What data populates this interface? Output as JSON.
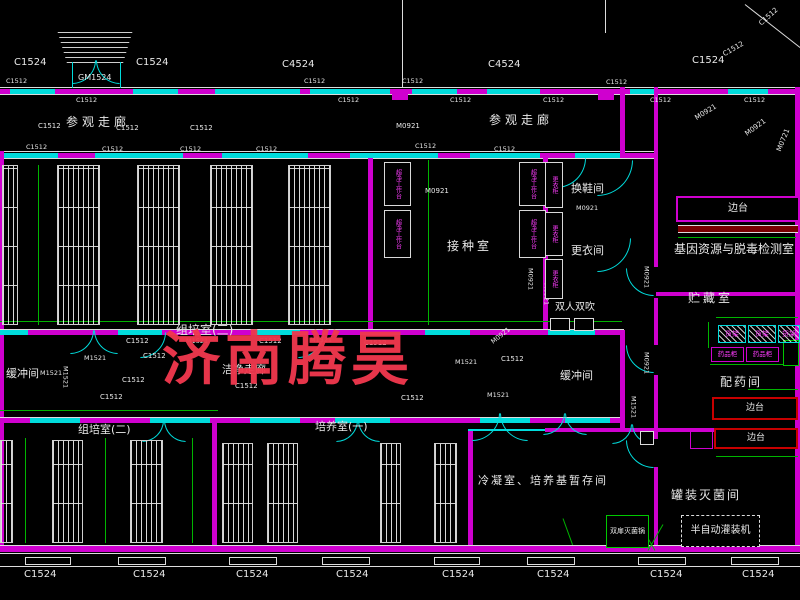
{
  "watermark": {
    "text": "济南腾昊",
    "color": "#f0384e"
  },
  "colors": {
    "wall_magenta": "#cf00cf",
    "window_cyan": "#00dcdc",
    "dim_green": "#00b400",
    "line_white": "#dcdcdc",
    "bench_red": "#c80000",
    "highlight_yellow": "#d8d800"
  },
  "labels": [
    {
      "n": "dim-c1524-1",
      "t": "C1524",
      "x": 14,
      "y": 58,
      "s": 10
    },
    {
      "n": "dim-c1524-2",
      "t": "C1524",
      "x": 136,
      "y": 58,
      "s": 10
    },
    {
      "n": "door-gm1524",
      "t": "GM1524",
      "x": 78,
      "y": 74,
      "s": 8
    },
    {
      "n": "dim-c4524-1",
      "t": "C4524",
      "x": 282,
      "y": 60,
      "s": 10
    },
    {
      "n": "dim-c4524-2",
      "t": "C4524",
      "x": 488,
      "y": 60,
      "s": 10
    },
    {
      "n": "dim-c1524-3",
      "t": "C1524",
      "x": 692,
      "y": 56,
      "s": 10
    },
    {
      "n": "dim-c1512-d1",
      "t": "C1512",
      "x": 722,
      "y": 52,
      "s": 7,
      "rot": -30
    },
    {
      "n": "dim-c1512-d2",
      "t": "C1512",
      "x": 758,
      "y": 22,
      "s": 7,
      "rot": -42
    },
    {
      "n": "dim-c1512",
      "t": "C1512",
      "x": 6,
      "y": 78,
      "s": 6.5
    },
    {
      "n": "dim-c1512",
      "t": "C1512",
      "x": 304,
      "y": 78,
      "s": 6.5
    },
    {
      "n": "dim-c1512",
      "t": "C1512",
      "x": 402,
      "y": 78,
      "s": 6.5
    },
    {
      "n": "dim-c1512",
      "t": "C1512",
      "x": 606,
      "y": 79,
      "s": 6.5
    },
    {
      "n": "dim-c1512",
      "t": "C1512",
      "x": 76,
      "y": 97,
      "s": 6.5
    },
    {
      "n": "dim-c1512",
      "t": "C1512",
      "x": 338,
      "y": 97,
      "s": 6.5
    },
    {
      "n": "dim-c1512",
      "t": "C1512",
      "x": 450,
      "y": 97,
      "s": 6.5
    },
    {
      "n": "dim-c1512",
      "t": "C1512",
      "x": 543,
      "y": 97,
      "s": 6.5
    },
    {
      "n": "dim-c1512",
      "t": "C1512",
      "x": 650,
      "y": 97,
      "s": 6.5
    },
    {
      "n": "dim-c1512",
      "t": "C1512",
      "x": 744,
      "y": 97,
      "s": 6.5
    },
    {
      "n": "dim-c1512",
      "t": "C1512",
      "x": 38,
      "y": 123,
      "s": 7
    },
    {
      "n": "room-visitor-corridor-1",
      "t": "参观走廊",
      "x": 66,
      "y": 116,
      "s": 12,
      "ls": 4
    },
    {
      "n": "dim-c1512",
      "t": "C1512",
      "x": 116,
      "y": 125,
      "s": 7
    },
    {
      "n": "dim-c1512",
      "t": "C1512",
      "x": 190,
      "y": 125,
      "s": 7
    },
    {
      "n": "dim-m0921",
      "t": "M0921",
      "x": 396,
      "y": 123,
      "s": 7
    },
    {
      "n": "room-visitor-corridor-2",
      "t": "参观走廊",
      "x": 489,
      "y": 114,
      "s": 12,
      "ls": 4
    },
    {
      "n": "dim-c1512",
      "t": "C1512",
      "x": 26,
      "y": 144,
      "s": 6.5
    },
    {
      "n": "dim-c1512",
      "t": "C1512",
      "x": 102,
      "y": 146,
      "s": 6.5
    },
    {
      "n": "dim-c1512",
      "t": "C1512",
      "x": 180,
      "y": 146,
      "s": 6.5
    },
    {
      "n": "dim-c1512",
      "t": "C1512",
      "x": 256,
      "y": 146,
      "s": 6.5
    },
    {
      "n": "dim-c1512",
      "t": "C1512",
      "x": 415,
      "y": 143,
      "s": 6.5
    },
    {
      "n": "dim-c1512",
      "t": "C1512",
      "x": 494,
      "y": 146,
      "s": 6.5
    },
    {
      "n": "dim-m0921-d",
      "t": "M0921",
      "x": 694,
      "y": 116,
      "s": 7,
      "rot": -32
    },
    {
      "n": "dim-m0921-d",
      "t": "M0921",
      "x": 744,
      "y": 132,
      "s": 7,
      "rot": -36
    },
    {
      "n": "dim-m0721-d",
      "t": "M0721",
      "x": 776,
      "y": 150,
      "s": 7,
      "rot": -68
    },
    {
      "n": "room-inoculation",
      "t": "接种室",
      "x": 447,
      "y": 240,
      "s": 12,
      "ls": 3
    },
    {
      "n": "dim-m0921",
      "t": "M0921",
      "x": 425,
      "y": 188,
      "s": 7
    },
    {
      "n": "dim-m0921",
      "t": "M0921",
      "x": 527,
      "y": 268,
      "s": 6.5,
      "v": true
    },
    {
      "n": "room-shoe-change",
      "t": "换鞋间",
      "x": 571,
      "y": 183,
      "s": 11
    },
    {
      "n": "dim-m0921",
      "t": "M0921",
      "x": 576,
      "y": 205,
      "s": 6.5
    },
    {
      "n": "room-dressing",
      "t": "更衣间",
      "x": 571,
      "y": 245,
      "s": 11
    },
    {
      "n": "room-air-shower",
      "t": "双人双吹",
      "x": 555,
      "y": 303,
      "s": 10
    },
    {
      "n": "dim-m0921",
      "t": "M0921",
      "x": 543,
      "y": 283,
      "s": 6.5,
      "v": true
    },
    {
      "n": "room-buffer-right",
      "t": "缓冲间",
      "x": 560,
      "y": 370,
      "s": 11
    },
    {
      "n": "dim-m1521",
      "t": "M1521",
      "x": 630,
      "y": 396,
      "s": 6.5,
      "v": true
    },
    {
      "n": "room-gene-detection",
      "t": "基因资源与脱毒检测室",
      "x": 674,
      "y": 243,
      "s": 12
    },
    {
      "n": "room-storage",
      "t": "贮藏室",
      "x": 688,
      "y": 292,
      "s": 12,
      "ls": 3
    },
    {
      "n": "room-dispensing",
      "t": "配药间",
      "x": 720,
      "y": 376,
      "s": 12,
      "ls": 2
    },
    {
      "n": "room-canning-sterilization",
      "t": "罐装灭菌间",
      "x": 671,
      "y": 489,
      "s": 12,
      "ls": 2
    },
    {
      "n": "dim-m0921",
      "t": "M0921",
      "x": 643,
      "y": 266,
      "s": 6.5,
      "v": true
    },
    {
      "n": "dim-m0921",
      "t": "M0921",
      "x": 643,
      "y": 352,
      "s": 6.5,
      "v": true
    },
    {
      "n": "room-tissue-culture-3",
      "t": "组培室(三)",
      "x": 176,
      "y": 324,
      "s": 12
    },
    {
      "n": "room-clean-corridor",
      "t": "洁净走廊",
      "x": 222,
      "y": 364,
      "s": 11
    },
    {
      "n": "room-buffer-left",
      "t": "缓冲间",
      "x": 6,
      "y": 368,
      "s": 11
    },
    {
      "n": "dim-m1521",
      "t": "M1521",
      "x": 40,
      "y": 370,
      "s": 6.5
    },
    {
      "n": "dim-m1521",
      "t": "M1521",
      "x": 62,
      "y": 366,
      "s": 6.5,
      "v": true
    },
    {
      "n": "dim-m1521",
      "t": "M1521",
      "x": 84,
      "y": 355,
      "s": 6.5
    },
    {
      "n": "dim-c1512",
      "t": "C1512",
      "x": 143,
      "y": 353,
      "s": 7
    },
    {
      "n": "dim-c1512",
      "t": "C1512",
      "x": 122,
      "y": 377,
      "s": 7
    },
    {
      "n": "dim-c1512",
      "t": "C1512",
      "x": 100,
      "y": 394,
      "s": 7
    },
    {
      "n": "dim-c1512",
      "t": "C1512",
      "x": 126,
      "y": 338,
      "s": 7
    },
    {
      "n": "dim-m1521",
      "t": "M1521",
      "x": 186,
      "y": 338,
      "s": 6.5
    },
    {
      "n": "dim-c1512",
      "t": "C1512",
      "x": 259,
      "y": 338,
      "s": 7
    },
    {
      "n": "dim-m1521",
      "t": "M1521",
      "x": 310,
      "y": 337,
      "s": 6.5
    },
    {
      "n": "dim-c1512",
      "t": "C1512",
      "x": 364,
      "y": 340,
      "s": 7
    },
    {
      "n": "dim-c1512",
      "t": "C1512",
      "x": 235,
      "y": 383,
      "s": 7
    },
    {
      "n": "dim-m1521",
      "t": "M1521",
      "x": 455,
      "y": 359,
      "s": 6.5
    },
    {
      "n": "dim-c1512",
      "t": "C1512",
      "x": 501,
      "y": 356,
      "s": 7
    },
    {
      "n": "dim-m0921-d",
      "t": "M0921",
      "x": 490,
      "y": 340,
      "s": 6.5,
      "rot": -38
    },
    {
      "n": "dim-m1521",
      "t": "M1521",
      "x": 487,
      "y": 392,
      "s": 6.5
    },
    {
      "n": "dim-c1512",
      "t": "C1512",
      "x": 401,
      "y": 395,
      "s": 7
    },
    {
      "n": "room-culture-1",
      "t": "培养室(一)",
      "x": 315,
      "y": 421,
      "s": 11
    },
    {
      "n": "room-tissue-culture-2",
      "t": "组培室(二)",
      "x": 78,
      "y": 424,
      "s": 11
    },
    {
      "n": "room-condensing",
      "t": "冷凝室、培养基暂存间",
      "x": 478,
      "y": 475,
      "s": 11,
      "ls": 2
    },
    {
      "n": "dim-c1524-b",
      "t": "C1524",
      "x": 24,
      "y": 570,
      "s": 10
    },
    {
      "n": "dim-c1524-b",
      "t": "C1524",
      "x": 133,
      "y": 570,
      "s": 10
    },
    {
      "n": "dim-c1524-b",
      "t": "C1524",
      "x": 236,
      "y": 570,
      "s": 10
    },
    {
      "n": "dim-c1524-b",
      "t": "C1524",
      "x": 336,
      "y": 570,
      "s": 10
    },
    {
      "n": "dim-c1524-b",
      "t": "C1524",
      "x": 442,
      "y": 570,
      "s": 10
    },
    {
      "n": "dim-c1524-b",
      "t": "C1524",
      "x": 537,
      "y": 570,
      "s": 10
    },
    {
      "n": "dim-c1524-b",
      "t": "C1524",
      "x": 650,
      "y": 570,
      "s": 10
    },
    {
      "n": "dim-c1524-b",
      "t": "C1524",
      "x": 742,
      "y": 570,
      "s": 10
    }
  ],
  "boxes": [
    {
      "n": "bench-side-table-detect",
      "t": "边台",
      "x": 676,
      "y": 196,
      "w": 124,
      "h": 26,
      "bc": "#cf00cf",
      "bw": 2,
      "tc": "#e8e8e8",
      "s": 10
    },
    {
      "n": "shelf-rack-1",
      "t": "货架",
      "x": 718,
      "y": 325,
      "w": 28,
      "h": 18,
      "bc": "#00dcdc",
      "bw": 1,
      "tc": "#ff3cff",
      "s": 7,
      "hatch": true
    },
    {
      "n": "shelf-rack-2",
      "t": "货架",
      "x": 748,
      "y": 325,
      "w": 28,
      "h": 18,
      "bc": "#00dcdc",
      "bw": 1,
      "tc": "#ff3cff",
      "s": 7,
      "hatch": true
    },
    {
      "n": "shelf-rack-3",
      "t": "货架",
      "x": 778,
      "y": 325,
      "w": 22,
      "h": 18,
      "bc": "#00dcdc",
      "bw": 1,
      "tc": "#ff3cff",
      "s": 7,
      "hatch": true
    },
    {
      "n": "medicine-cabinet-1",
      "t": "药品柜",
      "x": 711,
      "y": 347,
      "w": 33,
      "h": 15,
      "bc": "#cf00cf",
      "bw": 1,
      "tc": "#ff3cff",
      "s": 6.5
    },
    {
      "n": "medicine-cabinet-2",
      "t": "药品柜",
      "x": 746,
      "y": 347,
      "w": 33,
      "h": 15,
      "bc": "#cf00cf",
      "bw": 1,
      "tc": "#ff3cff",
      "s": 6.5
    },
    {
      "n": "bench-side-table-dispense",
      "t": "边台",
      "x": 712,
      "y": 397,
      "w": 86,
      "h": 23,
      "bc": "#c80000",
      "bw": 2,
      "tc": "#e8e8e8",
      "s": 9
    },
    {
      "n": "bench-side-table-canning",
      "t": "边台",
      "x": 714,
      "y": 428,
      "w": 84,
      "h": 21,
      "bc": "#c80000",
      "bw": 2,
      "tc": "#e8e8e8",
      "s": 9
    },
    {
      "n": "double-door-sterilizer",
      "t": "双扉灭菌锅",
      "x": 606,
      "y": 515,
      "w": 43,
      "h": 33,
      "bc": "#00c800",
      "bw": 1,
      "tc": "#e8e8e8",
      "s": 7
    },
    {
      "n": "semi-auto-filling-machine",
      "t": "半自动灌装机",
      "x": 681,
      "y": 515,
      "w": 79,
      "h": 32,
      "bc": "#dcdcdc",
      "bw": 1,
      "tc": "#e8e8e8",
      "s": 10,
      "dash": true
    },
    {
      "n": "clean-bench",
      "t": "超净工作台",
      "x": 384,
      "y": 162,
      "w": 27,
      "h": 44,
      "bc": "#d8d8d8",
      "bw": 1,
      "tc": "#ff3cff",
      "s": 6,
      "v": true
    },
    {
      "n": "clean-bench",
      "t": "超净工作台",
      "x": 384,
      "y": 210,
      "w": 27,
      "h": 48,
      "bc": "#d8d8d8",
      "bw": 1,
      "tc": "#ff3cff",
      "s": 6,
      "v": true
    },
    {
      "n": "clean-bench",
      "t": "超净工作台",
      "x": 519,
      "y": 162,
      "w": 27,
      "h": 44,
      "bc": "#d8d8d8",
      "bw": 1,
      "tc": "#ff3cff",
      "s": 6,
      "v": true
    },
    {
      "n": "clean-bench",
      "t": "超净工作台",
      "x": 519,
      "y": 210,
      "w": 27,
      "h": 48,
      "bc": "#d8d8d8",
      "bw": 1,
      "tc": "#ff3cff",
      "s": 6,
      "v": true
    },
    {
      "n": "locker",
      "t": "更衣柜",
      "x": 545,
      "y": 162,
      "w": 18,
      "h": 46,
      "bc": "#d8d8d8",
      "bw": 1,
      "tc": "#ff3cff",
      "s": 6,
      "v": true
    },
    {
      "n": "locker",
      "t": "更衣柜",
      "x": 545,
      "y": 212,
      "w": 18,
      "h": 44,
      "bc": "#d8d8d8",
      "bw": 1,
      "tc": "#ff3cff",
      "s": 6,
      "v": true
    },
    {
      "n": "locker",
      "t": "更衣柜",
      "x": 545,
      "y": 259,
      "w": 18,
      "h": 40,
      "bc": "#d8d8d8",
      "bw": 1,
      "tc": "#ff3cff",
      "s": 6,
      "v": true
    }
  ]
}
